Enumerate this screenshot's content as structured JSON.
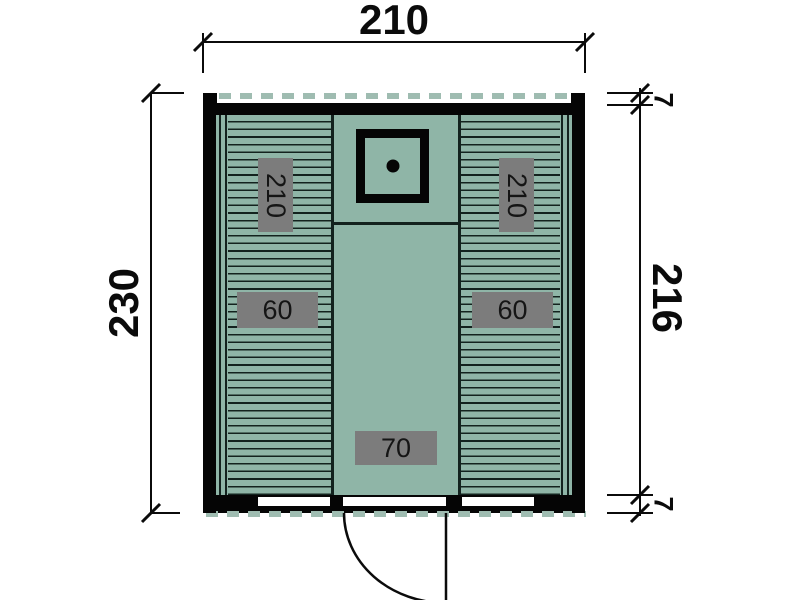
{
  "drawing": {
    "dimensions": {
      "top_width": "210",
      "left_height": "230",
      "right_height": "216",
      "overhang_top": "7",
      "overhang_bottom": "7"
    },
    "interior_labels": {
      "bench_left_length": "210",
      "bench_right_length": "210",
      "bench_left_width": "60",
      "bench_right_width": "60",
      "walkway_width": "70"
    },
    "colors": {
      "floor": "#8FB5A7",
      "plank_line": "#13221E",
      "wall": "#050505",
      "roof_dash": "#9FBCB1",
      "badge_bg": "#7C7C7C",
      "badge_text": "#151515"
    }
  }
}
